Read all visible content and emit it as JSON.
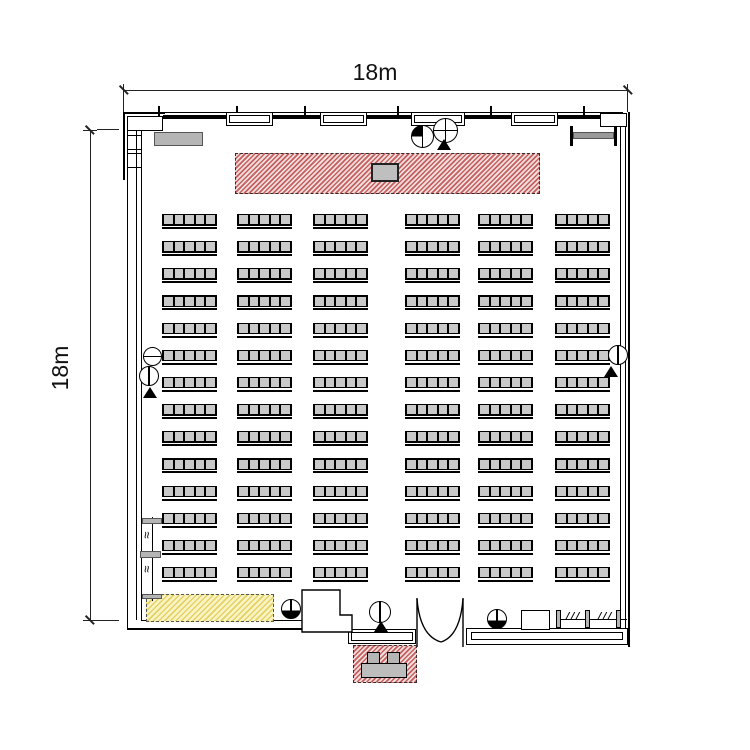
{
  "dimensions": {
    "top_label": "18m",
    "left_label": "18m"
  },
  "room": {
    "type": "banquet-hall-floor-plan",
    "colors": {
      "wall": "#000000",
      "stage_hatch": "#c4605f",
      "stage_base": "#f2dddd",
      "storage_hatch": "#e3d267",
      "storage_base": "#faf3c3",
      "seat_fill": "#c9c9c9",
      "cabinet_fill": "#b5b5b5",
      "beam_fill": "#9a9a9a"
    },
    "icons": {
      "ceiling_light": "circle-with-vertical-line",
      "ceiling_light_half": "circle-bottom-filled",
      "crosshair_fixture": "circle-with-cross",
      "speaker_marker": "filled-triangle",
      "break_mark": "triple-slash",
      "partition_squiggle": "wave-mark"
    },
    "windows_top_count": 4,
    "doors": {
      "main_entrance": "double-swing-door"
    },
    "seating": {
      "rows": 14,
      "columns": 6,
      "seats_per_block": 5,
      "total_blocks": 84,
      "total_seats": 420,
      "col_x": [
        162,
        237,
        313,
        405,
        478,
        555
      ],
      "row_start_y": 214,
      "row_pitch": 27.15,
      "block_width": 55,
      "seat_pitch": 10.6,
      "seat_width": 8.6,
      "aisle_after_column": 3
    }
  }
}
